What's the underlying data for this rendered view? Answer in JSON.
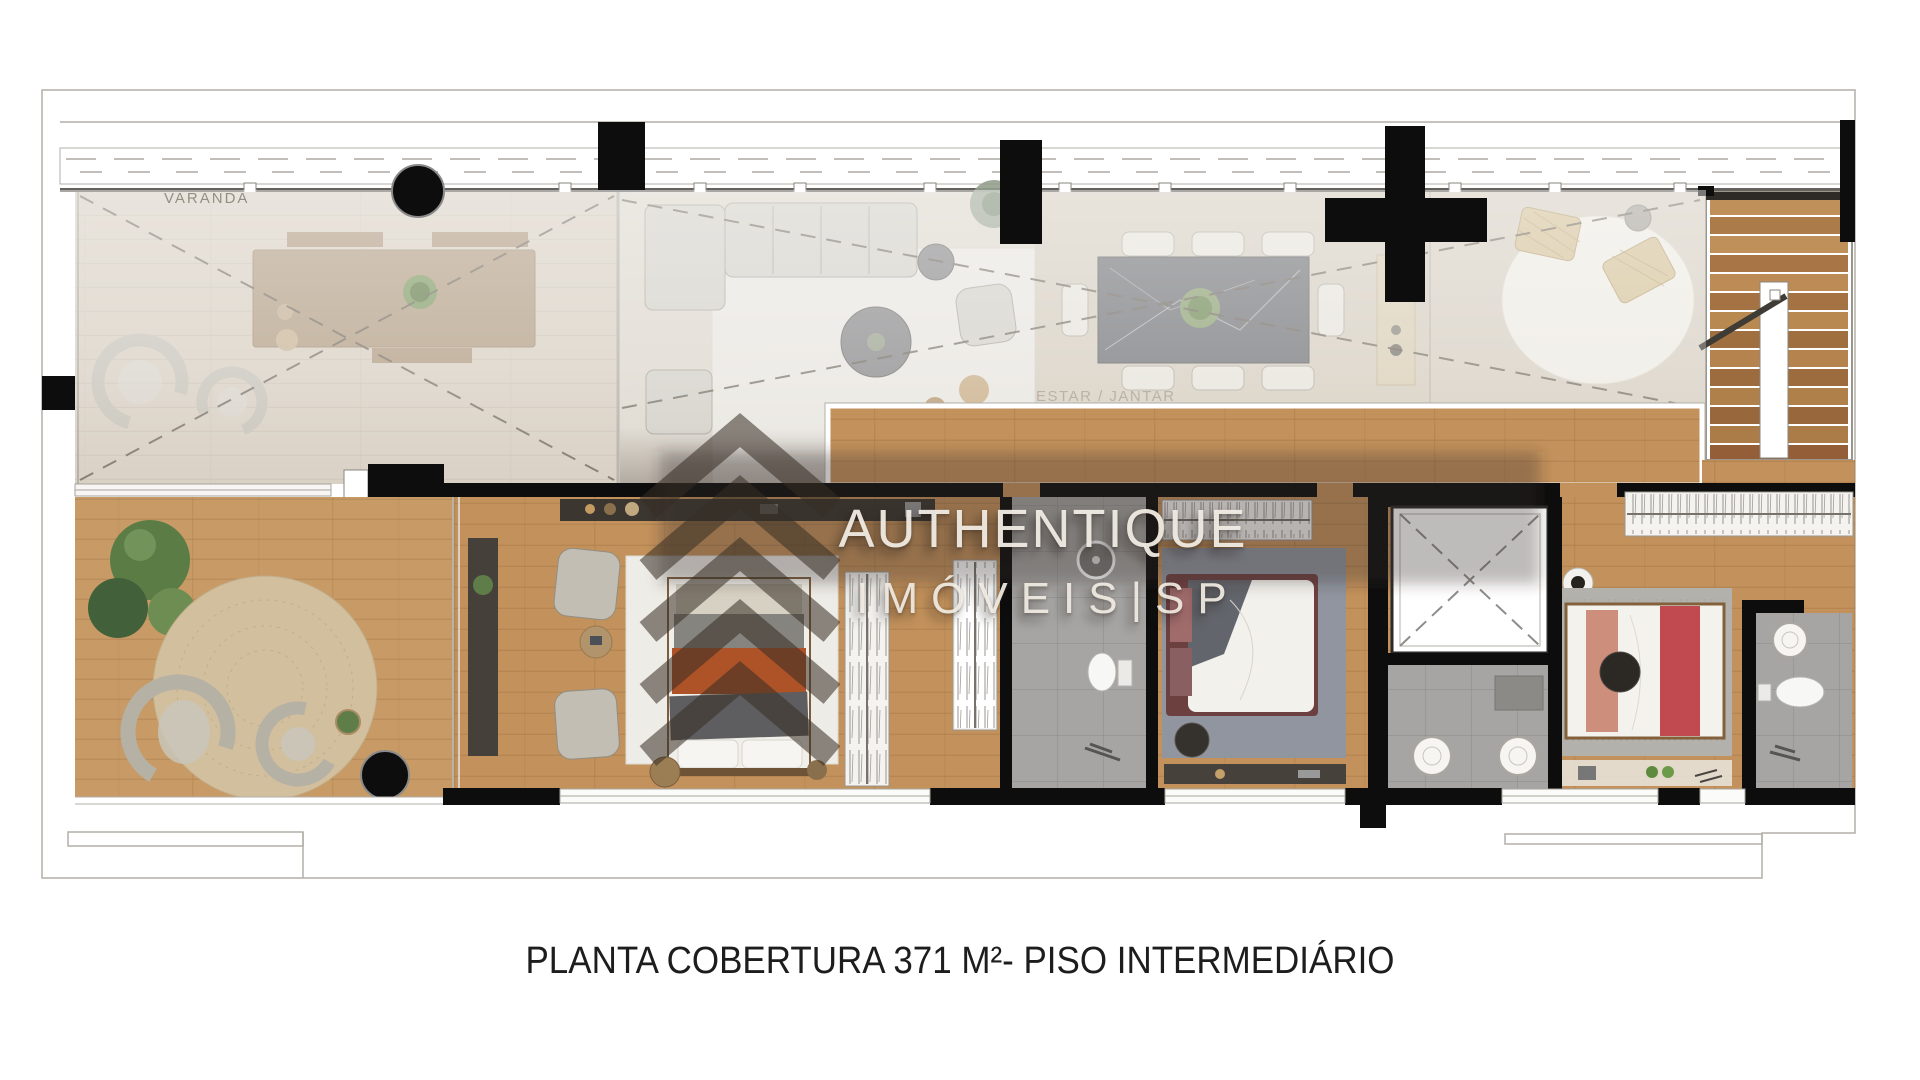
{
  "image": {
    "type": "floor-plan",
    "background": "#ffffff"
  },
  "plan": {
    "room_labels": {
      "varanda": "VARANDA",
      "estar_jantar": "ESTAR / JANTAR"
    },
    "watermark": {
      "brand": "AUTHENTIQUE",
      "subtitle": "IMÓVEIS|SP"
    },
    "caption": "PLANTA COBERTURA 371 M²- PISO INTERMEDIÁRIO",
    "colors": {
      "wall": "#0d0d0d",
      "wood_warm": "#c3925c",
      "wood_deck": "#c79a66",
      "floor_faded": "#d7cec1",
      "tile": "#a6a5a3",
      "rug_light": "#eeece7",
      "rug_blue": "#8d96a2",
      "rug_jute": "#d2bf9e",
      "accent_orange": "#ad5327",
      "accent_red": "#c04a50",
      "watermark_text": "#f0ebe2",
      "caption_text": "#1d1d1d"
    }
  }
}
